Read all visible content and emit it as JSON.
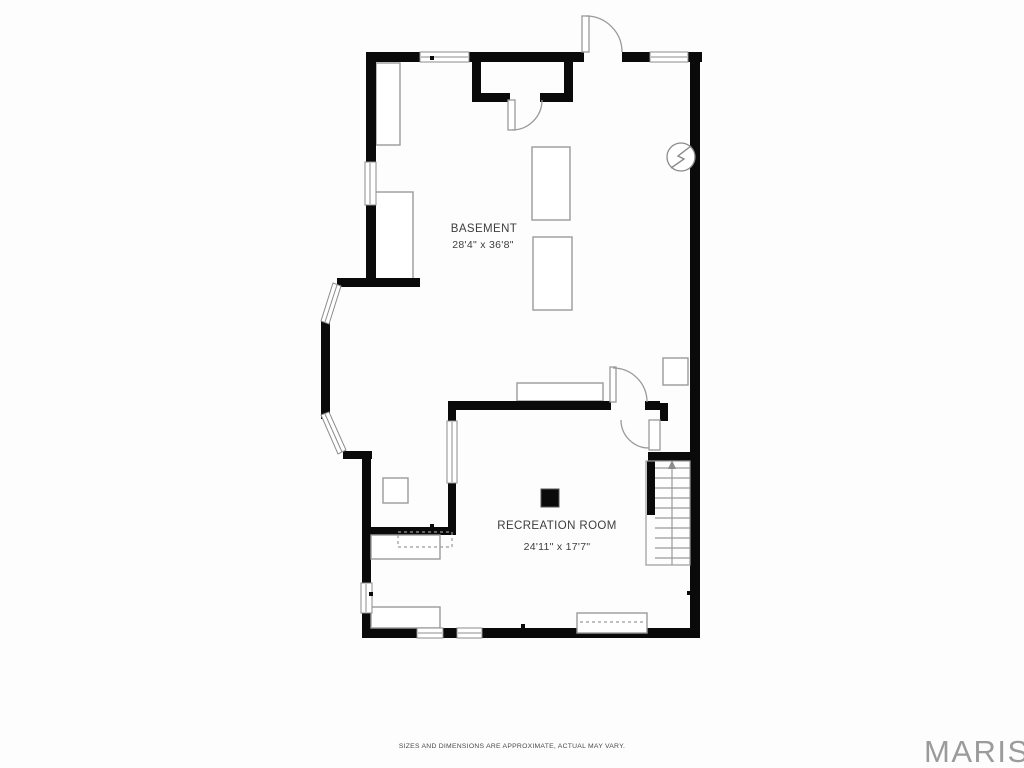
{
  "plan": {
    "title": "Basement floor plan",
    "rooms": [
      {
        "name": "BASEMENT",
        "dimensions": "28'4\" x 36'8\""
      },
      {
        "name": "RECREATION ROOM",
        "dimensions": "24'11\" x 17'7\""
      }
    ],
    "symbols": [
      {
        "name": "electrical-panel",
        "glyph": "circle-lightning"
      },
      {
        "name": "stairs",
        "direction": "up"
      }
    ]
  },
  "footer": {
    "disclaimer": "SIZES AND DIMENSIONS ARE APPROXIMATE, ACTUAL MAY VARY."
  },
  "branding": {
    "logo_text": "MARIS"
  },
  "colors": {
    "wall": "#0a0a0a",
    "fixture_outline": "#9a9a9a",
    "window_outline": "#8c8c8c",
    "label_text": "#3d3d3d",
    "logo_gray": "#9b9b9b"
  }
}
